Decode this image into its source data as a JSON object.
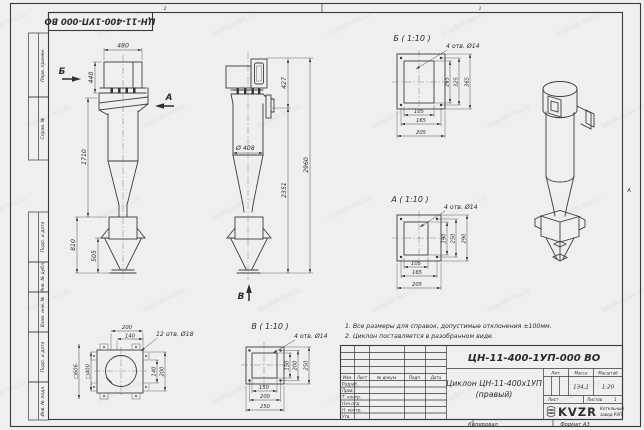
{
  "watermark": {
    "text": "vozduh-les.ru"
  },
  "frame": {
    "zone_top_2": "2",
    "zone_top_1": "1",
    "zone_right_a": "А",
    "copied": "Копировал",
    "format": "Формат А3"
  },
  "stamp_top": "ЦН-11-400-1УП-000 ВО",
  "margin_labels": [
    "Перв. примен.",
    "Справ. №",
    "Подп. и дата",
    "Инв. № дубл.",
    "Взам. инв. №",
    "Подп. и дата",
    "Инв. № подл."
  ],
  "notes": {
    "line1": "1. Все размеры для справок, допустимые отклонения ±100мм.",
    "line2": "2. Циклон поставляется в разобранном виде."
  },
  "front_view": {
    "dim_480": "480",
    "dim_440": "440",
    "dim_1710": "1710",
    "dim_810": "810",
    "dim_505": "505",
    "arrow_b": "Б",
    "arrow_a": "А"
  },
  "side_view": {
    "dim_427": "427",
    "dim_2351": "2351",
    "dim_2960": "2960",
    "dim_d408": "Ø 408",
    "arrow_v": "В"
  },
  "detail_b": {
    "title": "Б ( 1:10 )",
    "holes_note": "4 отв. Ø14",
    "dim_v_265": "265",
    "dim_v_325": "325",
    "dim_v_365": "365",
    "dim_h_105": "105",
    "dim_h_165": "165",
    "dim_h_205": "205"
  },
  "detail_a": {
    "title": "А ( 1:10 )",
    "holes_note": "4 отв. Ø14",
    "dim_v_190": "190",
    "dim_v_250": "250",
    "dim_v_290": "290",
    "dim_h_105": "105",
    "dim_h_165": "165",
    "dim_h_205": "205"
  },
  "detail_v": {
    "title": "В ( 1:10 )",
    "holes_note": "4 отв. Ø14",
    "dim_v_150": "150",
    "dim_v_200": "200",
    "dim_v_250": "250",
    "dim_h_150": "150",
    "dim_h_200": "200",
    "dim_h_250": "250"
  },
  "top_view": {
    "dim_200_top": "200",
    "dim_140_top": "140",
    "holes_note": "12 отв. Ø18",
    "dim_140_right": "140",
    "dim_200_right": "200",
    "dim_sq606": "□606",
    "dim_sq400": "□400"
  },
  "title_block": {
    "doc_number": "ЦН-11-400-1УП-000 ВО",
    "doc_title": "Циклон ЦН-11-400х1УП",
    "doc_subtitle": "(правый)",
    "header": {
      "izm": "Изм",
      "list": "Лист",
      "n_doc": "№ докум.",
      "podp": "Подп.",
      "data": "Дата"
    },
    "rows": [
      "Разраб.",
      "Пров.",
      "Т. контр.",
      "Нач.отд.",
      "Н. контр.",
      "Утв."
    ],
    "lit_label": "Лит.",
    "mass_label": "Масса",
    "scale_label": "Масштаб",
    "mass_value": "134,1",
    "scale_value": "1:20",
    "sheet_label": "Лист",
    "sheets_label": "Листов",
    "sheets_value": "1",
    "org_logo": "KVZR",
    "org_name_line1": "Котельный",
    "org_name_line2": "завод РЭП"
  }
}
